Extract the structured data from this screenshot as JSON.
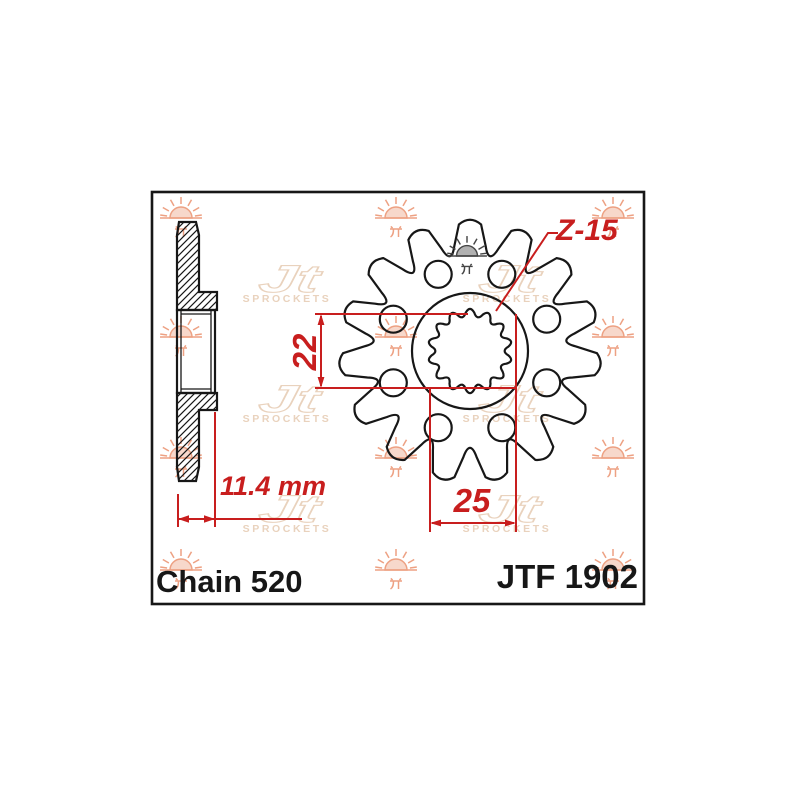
{
  "labels": {
    "chain": "Chain 520",
    "part_number": "JTF 1902",
    "hub_width_dim": "11.4 mm",
    "spline_inner_dim": "22",
    "spline_outer_dim": "25",
    "teeth_count_label": "Z-15"
  },
  "watermark": {
    "logo_text": "Jt",
    "logo_caption": "SPROCKETS",
    "sun_icon": "sunrise-jt-icon"
  },
  "gear": {
    "teeth": 15,
    "relief_holes": 8,
    "spline_teeth": 14
  },
  "colors": {
    "dimension_red": "#c81e1e",
    "drawing_black": "#171717",
    "watermark_salmon": "#eda habit"
  }
}
